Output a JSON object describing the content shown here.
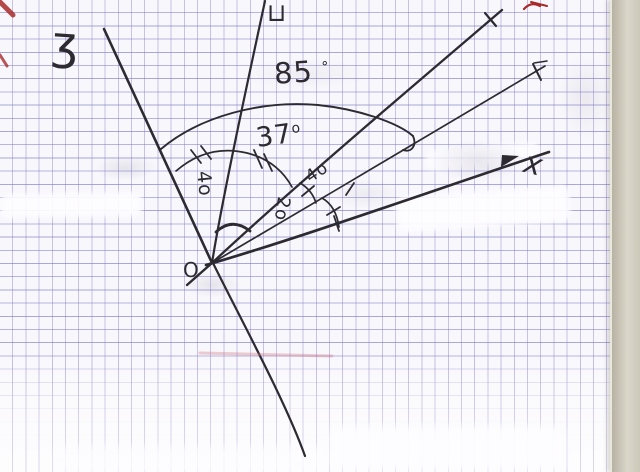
{
  "colors": {
    "paper": "#f8f7fb",
    "grid_line": "#8d84c9",
    "ink": "#2d2b31",
    "red_mark": "#a82a2a",
    "page_edge": "#c9c4b6"
  },
  "labels": {
    "ray_z": "ʒ",
    "ray_u": "⊔",
    "ray_x": "x",
    "vertex": "O",
    "angle_big_value": "85",
    "angle_big_degree": "°",
    "angle_mid_value": "37",
    "angle_mid_degree": "o",
    "angle_zu": "4o",
    "angle_inner_upper": "4o",
    "angle_inner_lower": "2o"
  },
  "diagram": {
    "type": "hand-drawn angle diagram on squared notebook paper",
    "vertex": "O",
    "rays": [
      {
        "id": "ray-z",
        "label": "ʒ",
        "direction": "up-left",
        "tip_mark": "none"
      },
      {
        "id": "ray-u",
        "label": "⊔",
        "direction": "up",
        "tip_mark": "none"
      },
      {
        "id": "ray-upper-right",
        "label": "",
        "direction": "steep up-right",
        "tip_mark": "tick"
      },
      {
        "id": "ray-mid-right",
        "label": "",
        "direction": "up-right",
        "tip_mark": "tick"
      },
      {
        "id": "ray-x",
        "label": "x",
        "direction": "right slightly up",
        "tip_mark": "tick",
        "has_arrowhead": true
      },
      {
        "id": "ray-down",
        "label": "",
        "direction": "down-right",
        "tip_mark": "none"
      }
    ],
    "angle_annotations": [
      {
        "between": "ray-z and ray-mid-right",
        "mark": "large arc with end hook",
        "label": "85 °"
      },
      {
        "between": "ray-z and ray-u",
        "mark": "arc with double ticks",
        "label": "4o"
      },
      {
        "between": "ray-u and ray-upper-right",
        "mark": "arc with double ticks",
        "label": "37o"
      },
      {
        "between": "ray-upper-right and ray-mid-right",
        "mark": "small arc with single tick",
        "label": "4o"
      },
      {
        "between": "ray-mid-right and ray-x",
        "mark": "small arc with single ticks",
        "label": "2o"
      },
      {
        "between": "ray-u and ray-upper-right near vertex",
        "mark": "small bold arc",
        "label": ""
      }
    ],
    "extra_marks": [
      "red corner stroke top-left",
      "red tick top-right",
      "faint pink streak below vertex",
      "correction-fluid white patches",
      "pencil smudges"
    ]
  }
}
